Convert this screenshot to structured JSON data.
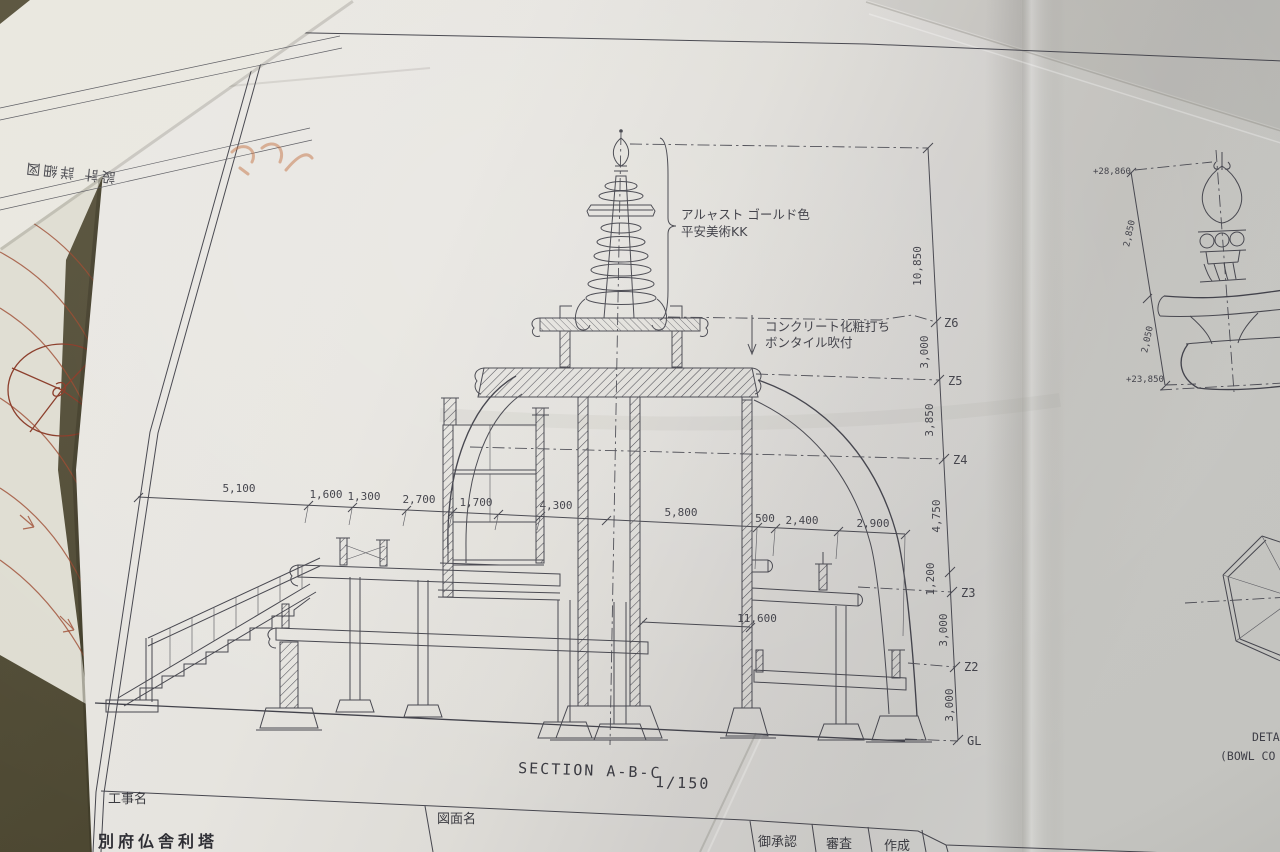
{
  "photo": {
    "description": "Photograph of a folded architectural blueprint on a table",
    "paper_color": "#e6e4df",
    "table_color": "#55503a",
    "ink_color": "#45454d",
    "red_pencil_color": "#9c4a30"
  },
  "under_sheet": {
    "label": "設計 詳細図"
  },
  "main_drawing": {
    "section_title": "SECTION A-B-C",
    "section_scale": "1/150",
    "finial_note": [
      "アルャスト ゴールド色",
      "平安美術KK"
    ],
    "concrete_note": [
      "コンクリート化粧打ち",
      "ボンタイル吹付"
    ],
    "horizontal_dims": [
      "5,100",
      "1,600",
      "1,300",
      "2,700",
      "1,700",
      "4,300",
      "5,800",
      "500",
      "2,400",
      "2,900"
    ],
    "inner_dim": "11,600",
    "vertical_dims": [
      "10,850",
      "3,000",
      "3,850",
      "4,750",
      "1,200",
      "3,000",
      "3,000"
    ],
    "level_labels": [
      "Z6",
      "Z5",
      "Z4",
      "Z3",
      "Z2",
      "GL"
    ]
  },
  "detail_drawing": {
    "elevation_top": "+28,860",
    "elevation_bottom": "+23,850",
    "dim_upper": "2,850",
    "dim_lower": "2,050",
    "caption_line1": "DETAI",
    "caption_line2": "(BOWL CO"
  },
  "title_block": {
    "project_label": "工事名",
    "project_name": "別府仏舎利塔",
    "drawing_label": "図面名",
    "approve_label": "御承認",
    "review_label": "審査",
    "create_label": "作成"
  }
}
